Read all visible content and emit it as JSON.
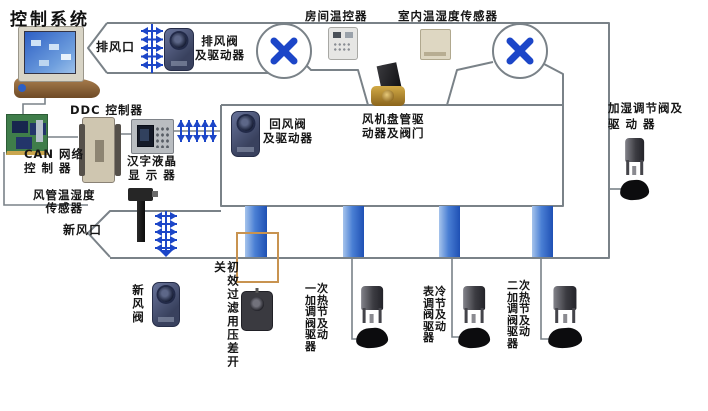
{
  "title": "控制系统",
  "colors": {
    "duct_line": "#7a8288",
    "symbol_blue": "#1c46c8",
    "coil_bar": "#2257c0",
    "filter_frame": "#c89350"
  },
  "icons": {
    "fan": "pinwheel-x-icon",
    "damper": "double-arrow-tick-icon",
    "fieldbus": "double-arrow-tick-icon"
  },
  "labels": {
    "exhaust_outlet": "排风口",
    "exhaust_valve": "排风阀\n及驱动器",
    "room_thermostat": "房间温控器",
    "indoor_sensor": "室内温湿度传感器",
    "humid_valve": "加湿调节阀及\n驱 动 器",
    "ddc": "DDC 控制器",
    "can": "CAN 网络\n控 制 器",
    "lcd": "汉字液晶\n显 示 器",
    "return_valve": "回风阀\n及驱动器",
    "fan_coil": "风机盘管驱\n动器及阀门",
    "duct_sensor": "风管温湿度\n传感器",
    "fresh_outlet": "新风口",
    "fresh_valve": "新风阀",
    "filter_switch": "初效过滤用压差开关",
    "valve_primary_heat": "一次\n加热\n调节\n阀及\n驱动\n器",
    "valve_cooling": "表冷\n调节\n阀及\n驱动\n器",
    "valve_secondary_heat": "二次\n加热\n调节\n阀及\n驱动\n器"
  }
}
